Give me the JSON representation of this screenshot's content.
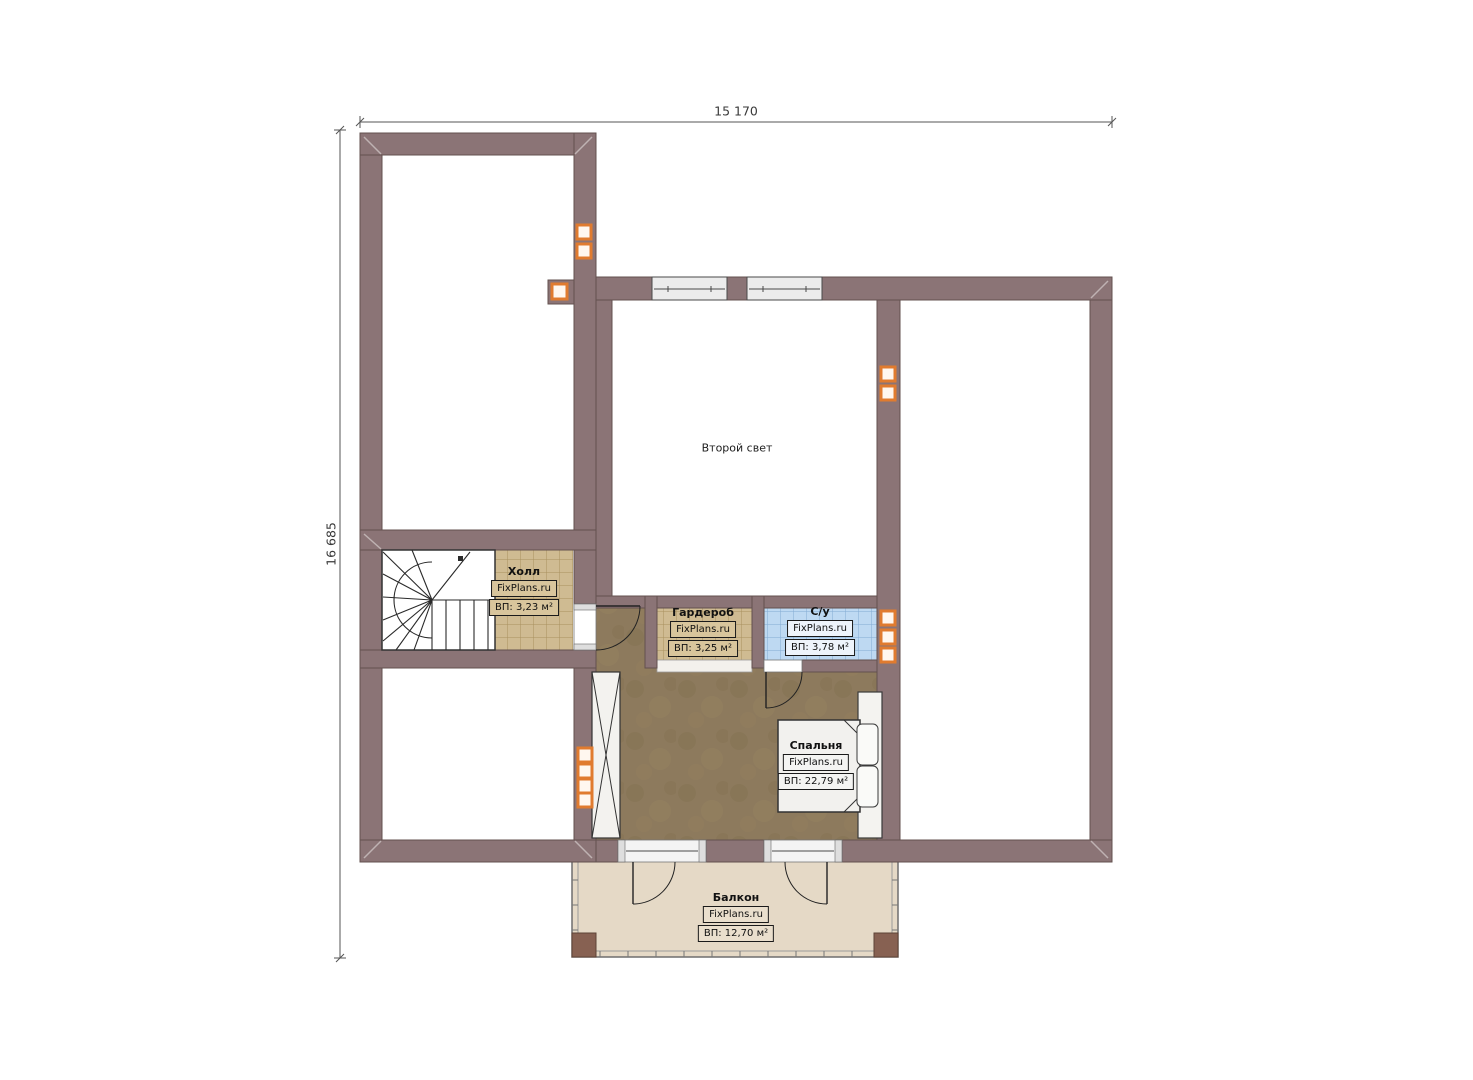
{
  "plan": {
    "type": "floor-plan",
    "language": "ru"
  },
  "dimensions": {
    "width_label": "15 170",
    "height_label": "16 685"
  },
  "rooms": {
    "second_light": {
      "name": "Второй свет"
    },
    "hall": {
      "name": "Холл",
      "brand": "FixPlans.ru",
      "area": "ВП: 3,23 м²"
    },
    "wardrobe": {
      "name": "Гардероб",
      "brand": "FixPlans.ru",
      "area": "ВП: 3,25 м²"
    },
    "bathroom": {
      "name": "С/у",
      "brand": "FixPlans.ru",
      "area": "ВП: 3,78 м²"
    },
    "bedroom": {
      "name": "Спальня",
      "brand": "FixPlans.ru",
      "area": "ВП: 22,79 м²"
    },
    "balcony": {
      "name": "Балкон",
      "brand": "FixPlans.ru",
      "area": "ВП: 12,70 м²"
    }
  },
  "colors": {
    "wall": "#8b7476",
    "wall_outline": "#63514f",
    "hall_floor": "#cfbb92",
    "bathroom_floor": "#bed9f2",
    "bedroom_floor": "#8d7a5d",
    "balcony_floor": "#e5d9c6",
    "vent_accent": "#e07b2f"
  }
}
